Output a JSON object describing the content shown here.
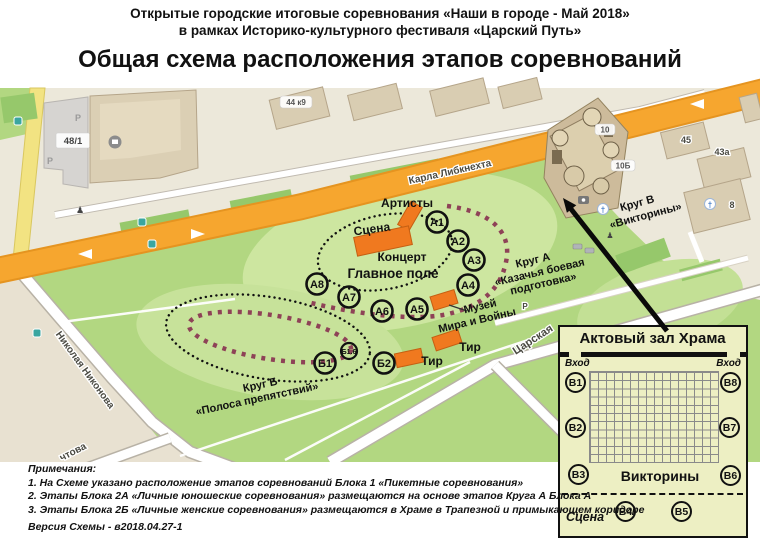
{
  "header": {
    "line1": "Открытые городские итоговые соревнования «Наши в городе - Май 2018»",
    "line2": "в рамках Историко-культурного фестиваля «Царский Путь»",
    "title": "Общая схема расположения этапов соревнований"
  },
  "map": {
    "streets": {
      "karla_libknehta": "Карла Либкнехта",
      "tsarskaya": "Царская",
      "nikolaya_nikonova": "Николая Никонова",
      "chtova": "чтова"
    },
    "building_labels": {
      "b48_1": "48/1",
      "b44k9": "44 к9",
      "b10": "10",
      "b10b": "10Б",
      "b45": "45",
      "b43a": "43а",
      "b8": "8",
      "parking1": "Р",
      "parking2": "Р",
      "parking3": "Р"
    },
    "labels": {
      "artists": "Артисты",
      "stage": "Сцена",
      "concert": "Концерт",
      "main_field": "Главное поле",
      "museum_line1": "Музей",
      "museum_line2": "Мира и Войны",
      "tir1": "Тир",
      "tir2": "Тир",
      "krugA_line1": "Круг А",
      "krugA_line2": "«Казачья боевая",
      "krugA_line3": "подготовка»",
      "krugB_line1": "Круг Б",
      "krugB_line2": "«Полоса препятствий»",
      "krugV_line1": "Круг В",
      "krugV_line2": "«Викторины»"
    },
    "points_a": [
      "А1",
      "А2",
      "А3",
      "А4",
      "А5",
      "А6",
      "А7",
      "А8"
    ],
    "points_b": [
      "Б1",
      "Б1.6",
      "Б2"
    ]
  },
  "inset": {
    "title": "Актовый зал Храма",
    "entrance_left": "Вход",
    "entrance_right": "Вход",
    "center_label": "Викторины",
    "stage_label": "Сцена",
    "points_left": [
      "В1",
      "В2",
      "В3"
    ],
    "points_right": [
      "В8",
      "В7",
      "В6"
    ],
    "points_bottom": [
      "В4",
      "В5"
    ]
  },
  "notes": {
    "heading": "Примечания:",
    "items": [
      "1. На Схеме указано расположение этапов соревнований Блока 1 «Пикетные соревнования»",
      "2. Этапы Блока 2А «Личные юношеские соревнования» размещаются на основе этапов Круга А Блока А",
      "3. Этапы Блока 2Б «Личные женские соревнования» размещаются в Храме в Трапезной и примыкающем коридоре"
    ],
    "version": "Версия Схемы - в2018.04.27-1"
  },
  "colors": {
    "park_green": "#b2d781",
    "field_green": "#cde6a0",
    "hedge_green": "#96c86b",
    "road_orange": "#f6a62f",
    "road_yellow": "#f2e382",
    "stage_orange": "#f0791f",
    "route_maroon": "#8e4257",
    "inset_bg": "#edefc3",
    "map_beige": "#ece8da"
  }
}
